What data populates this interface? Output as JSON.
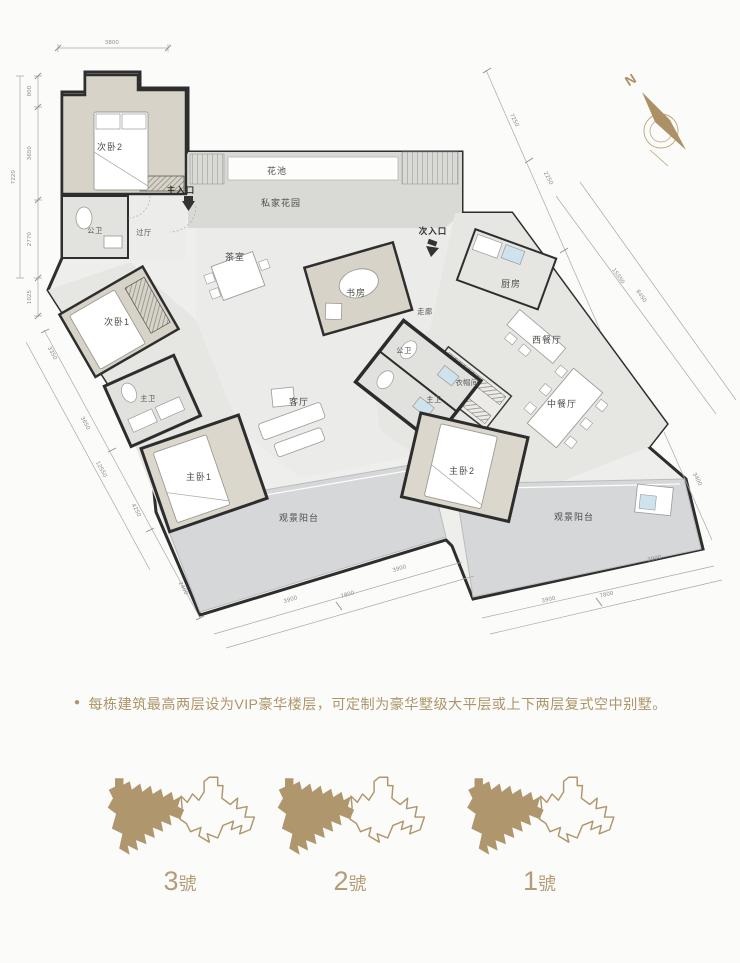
{
  "plan": {
    "rooms": {
      "bedroom2": "次卧2",
      "bath_public_upper": "公卫",
      "hallway": "过厅",
      "main_entrance": "主入口",
      "flower_bed": "花池",
      "private_garden": "私家花园",
      "tea_room": "茶室",
      "study": "书房",
      "second_entrance": "次入口",
      "corridor": "走廊",
      "kitchen": "厨房",
      "western_dining": "西餐厅",
      "chinese_dining": "中餐厅",
      "cloakroom": "衣帽间",
      "bath_public_mid": "公卫",
      "master_bath2": "主卫",
      "bedroom1": "次卧1",
      "master_bath1": "主卫",
      "living": "客厅",
      "master_bedroom1": "主卧1",
      "master_bedroom2": "主卧2",
      "balcony_left": "观景阳台",
      "balcony_right": "观景阳台"
    },
    "dims": {
      "top": "3800",
      "left": [
        "800",
        "3650",
        "2770",
        "1025"
      ],
      "left_total": "7220",
      "upper_right": [
        "7250",
        "2250"
      ],
      "right_long": [
        "15350",
        "8450"
      ],
      "lower_left": [
        "3350",
        "3650",
        "12550",
        "4250",
        "2400"
      ],
      "bottom_left": [
        "3900",
        "7800",
        "3900"
      ],
      "bottom_right": [
        "3900",
        "7800",
        "3900"
      ],
      "right_side": "3400"
    },
    "compass_label": "N"
  },
  "note": {
    "bullet": "●",
    "text": "每栋建筑最高两层设为VIP豪华楼层，可定制为豪华墅级大平层或上下两层复式空中别墅。"
  },
  "buildings": [
    {
      "num": "3",
      "suffix": "號"
    },
    {
      "num": "2",
      "suffix": "號"
    },
    {
      "num": "1",
      "suffix": "號"
    }
  ],
  "colors": {
    "accent_gold": "#b2996f",
    "wall": "#2e2e2e",
    "bedroom_fill": "#d7d3c8",
    "balcony_fill": "#d6d7d8"
  }
}
